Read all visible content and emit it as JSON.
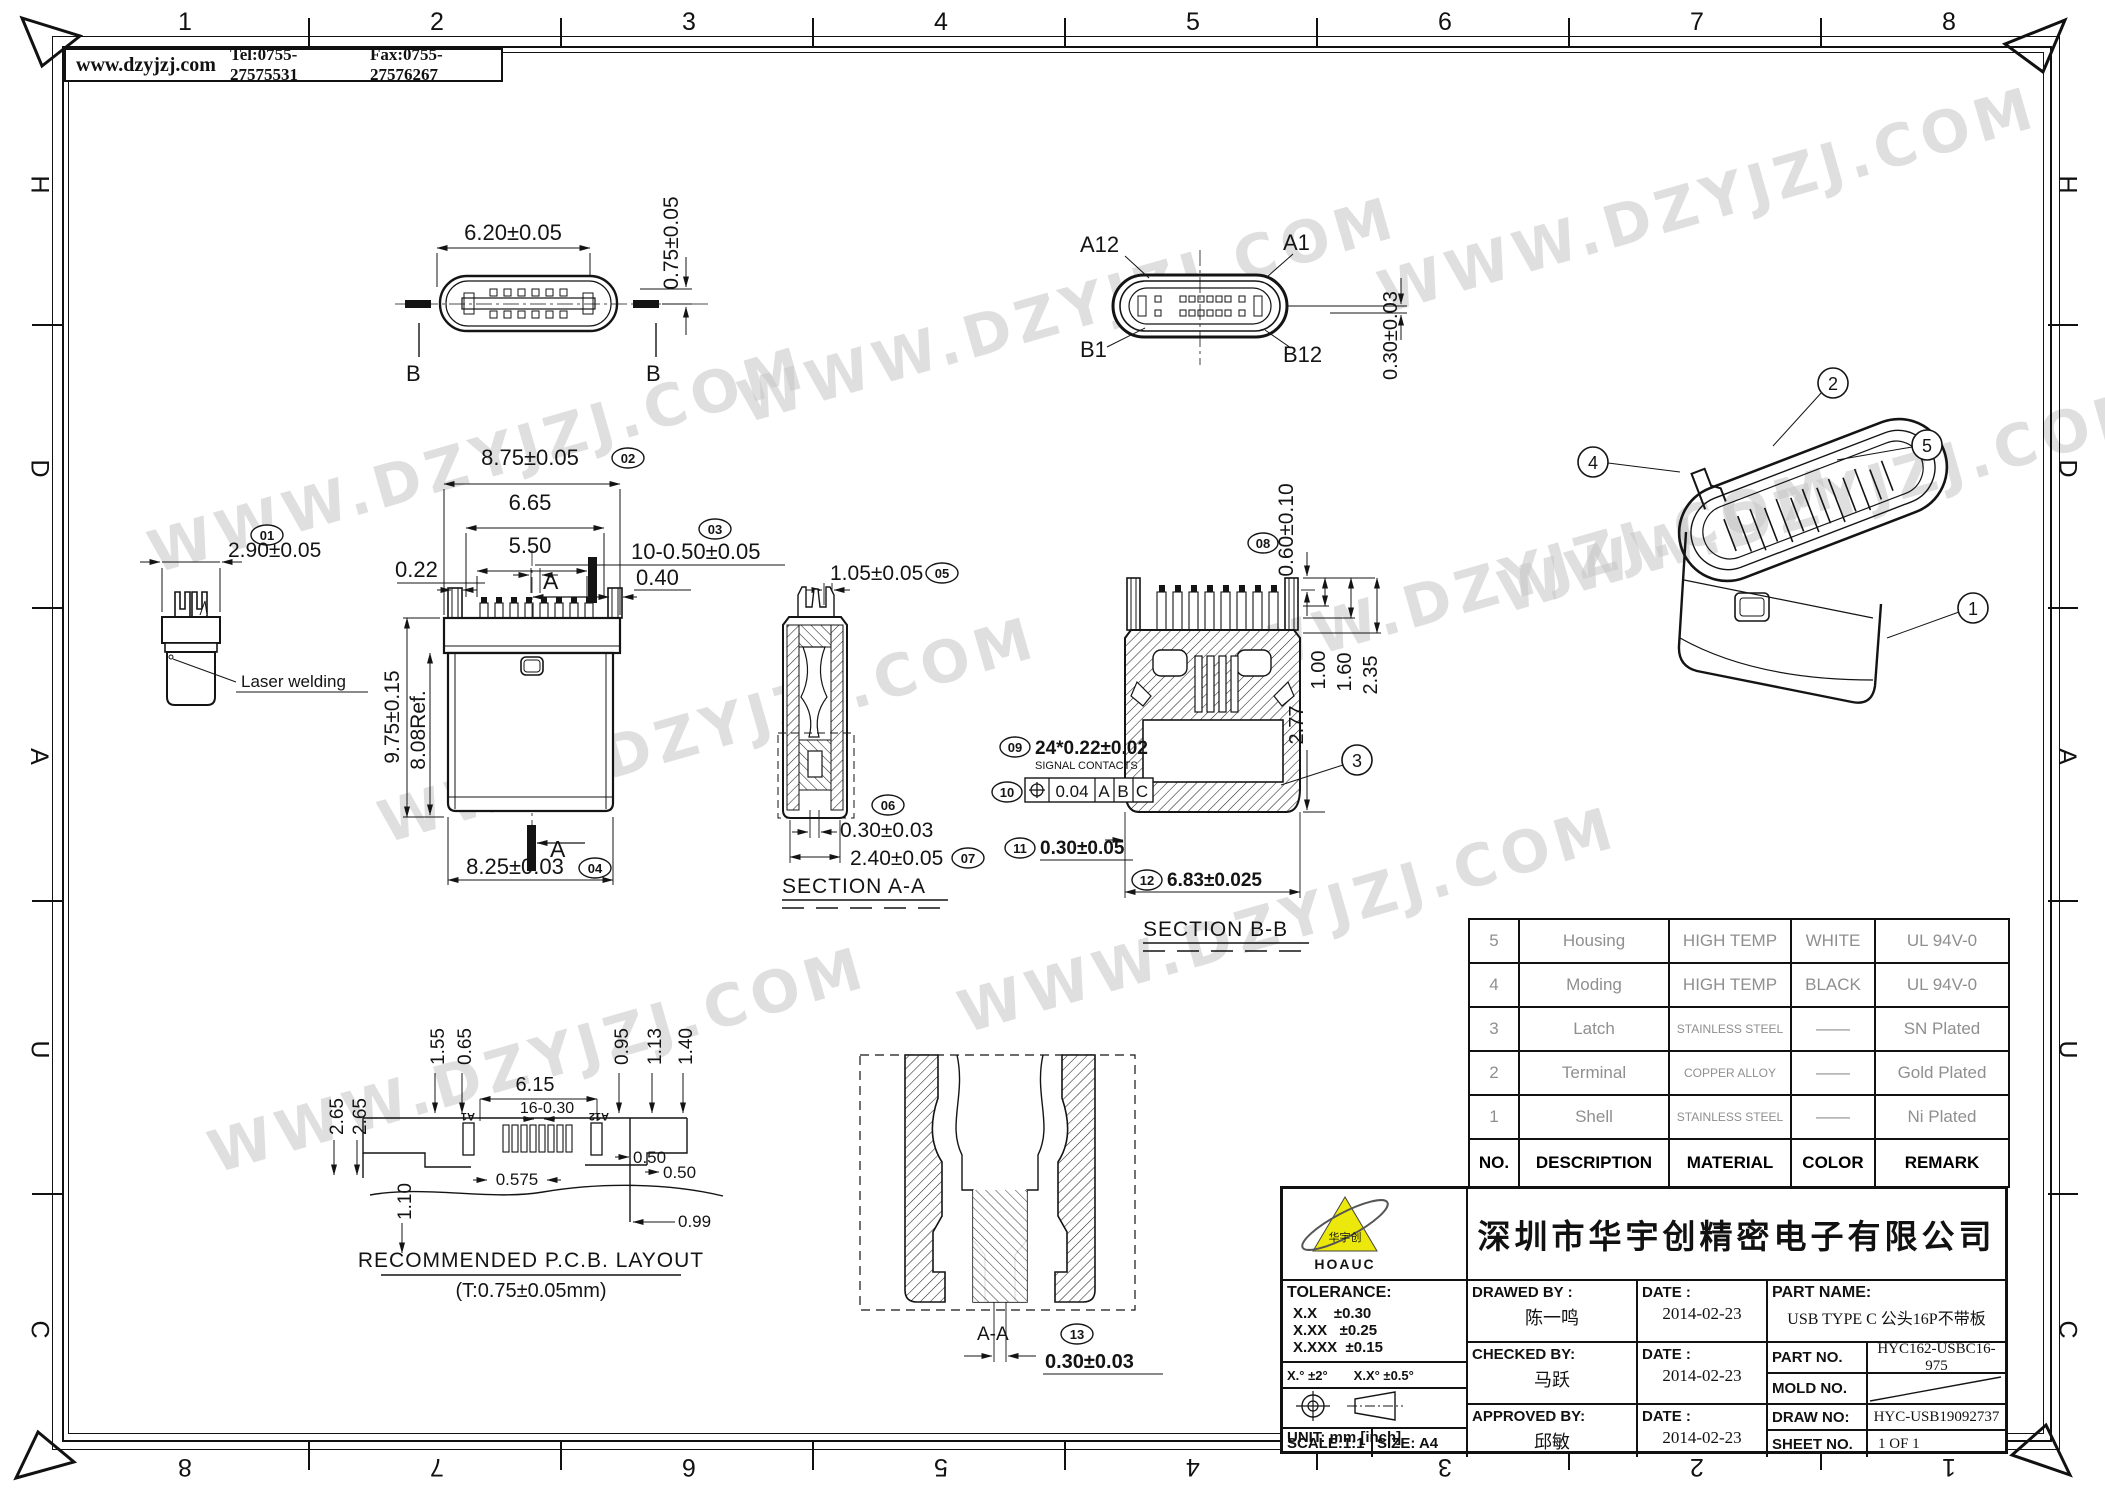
{
  "header": {
    "website": "www.dzyjzj.com",
    "tel": "Tel:0755-27575531",
    "fax": "Fax:0755-27576267"
  },
  "zones": {
    "top": [
      "1",
      "2",
      "3",
      "4",
      "5",
      "6",
      "7",
      "8"
    ],
    "bottom": [
      "8",
      "7",
      "6",
      "5",
      "4",
      "3",
      "2",
      "1"
    ],
    "left": [
      "H",
      "D",
      "A",
      "U",
      "C"
    ],
    "right": [
      "H",
      "D",
      "A",
      "U",
      "C"
    ]
  },
  "watermark": {
    "text": "WWW.DZYJZJ.COM"
  },
  "top_view": {
    "dim_width": "6.20±0.05",
    "dim_height": "0.75±0.05",
    "cut_left": "B",
    "cut_right": "B"
  },
  "face_view": {
    "a12": "A12",
    "a1": "A1",
    "b1": "B1",
    "b12": "B12",
    "dim": "0.30±0.03"
  },
  "side_view": {
    "balloon": "01",
    "dim": "2.90±0.05",
    "note": "Laser welding"
  },
  "front_view": {
    "b02": "02",
    "d875": "8.75±0.05",
    "d665": "6.65",
    "d550": "5.50",
    "b03": "03",
    "d1050": "10-0.50±0.05",
    "d022": "0.22",
    "d040": "0.40",
    "a_top": "A",
    "a_bottom": "A",
    "d975": "9.75±0.15",
    "d808": "8.08Ref.",
    "b04": "04",
    "d825": "8.25±0.03"
  },
  "section_aa": {
    "b05": "05",
    "d105": "1.05±0.05",
    "b06": "06",
    "d030": "0.30±0.03",
    "b07": "07",
    "d240": "2.40±0.05",
    "title": "SECTION A-A"
  },
  "section_bb": {
    "b08": "08",
    "d060": "0.60±0.10",
    "d100": "1.00",
    "d160": "1.60",
    "d235": "2.35",
    "d277": "2.77",
    "b3": "3",
    "b09": "09",
    "d2422": "24*0.22±0.02",
    "signal": "SIGNAL  CONTACTS",
    "b10": "10",
    "fcf_tol": "0.04",
    "fcf_a": "A",
    "fcf_b": "B",
    "fcf_c": "C",
    "b11": "11",
    "d03005": "0.30±0.05",
    "b12": "12",
    "d683": "6.83±0.025",
    "title": "SECTION B-B"
  },
  "iso": {
    "b1": "1",
    "b2": "2",
    "b4": "4",
    "b5": "5"
  },
  "pcb": {
    "d155": "1.55",
    "d065": "0.65",
    "d615": "6.15",
    "d1630": "16-0.30",
    "d095": "0.95",
    "d113": "1.13",
    "d140": "1.40",
    "d265a": "2.65",
    "d265b": "2.65",
    "d110": "1.10",
    "d0575": "0.575",
    "d050a": "0.50",
    "d050b": "0.50",
    "d099": "0.99",
    "a1": "A1",
    "a12": "A12",
    "title": "RECOMMENDED   P.C.B.  LAYOUT",
    "subtitle": "(T:0.75±0.05mm)"
  },
  "detail": {
    "label": "A-A",
    "b13": "13",
    "dim": "0.30±0.03"
  },
  "parts_table": {
    "headers": [
      "NO.",
      "DESCRIPTION",
      "MATERIAL",
      "COLOR",
      "REMARK"
    ],
    "rows": [
      [
        "5",
        "Housing",
        "HIGH TEMP",
        "WHITE",
        "UL 94V-0"
      ],
      [
        "4",
        "Moding",
        "HIGH TEMP",
        "BLACK",
        "UL 94V-0"
      ],
      [
        "3",
        "Latch",
        "STAINLESS STEEL",
        "——",
        "SN Plated"
      ],
      [
        "2",
        "Terminal",
        "COPPER ALLOY",
        "——",
        "Gold Plated"
      ],
      [
        "1",
        "Shell",
        "STAINLESS STEEL",
        "——",
        "Ni Plated"
      ]
    ]
  },
  "title_block": {
    "logo_mark": "华宇创",
    "logo_text": "HOAUC",
    "company": "深圳市华宇创精密电子有限公司",
    "tolerance_title": "TOLERANCE:",
    "tol1": "X.X    ±0.30",
    "tol2": "X.XX   ±0.25",
    "tol3": "X.XXX  ±0.15",
    "tol_angle": "X.°  ±2°",
    "tol_angle2": "X.X°  ±0.5°",
    "unit": "UNIT:  mm  [inch]",
    "scale": "SCALE:1:1",
    "size": "SIZE:  A4",
    "drawed_label": "DRAWED BY :",
    "drawed": "陈一鸣",
    "checked_label": "CHECKED BY:",
    "checked": "马跃",
    "approved_label": "APPROVED BY:",
    "approved": "邱敏",
    "date_label1": "DATE :",
    "date_label2": "DATE :",
    "date_label3": "DATE :",
    "date1": "2014-02-23",
    "date2": "2014-02-23",
    "date3": "2014-02-23",
    "part_name_label": "PART NAME:",
    "part_name": "USB TYPE C 公头16P不带板",
    "part_no_label": "PART NO.",
    "part_no": "HYC162-USBC16-975",
    "mold_label": "MOLD NO.",
    "draw_no_label": "DRAW NO:",
    "draw_no": "HYC-USB19092737",
    "sheet_label": "SHEET NO.",
    "sheet": "1 OF 1"
  }
}
